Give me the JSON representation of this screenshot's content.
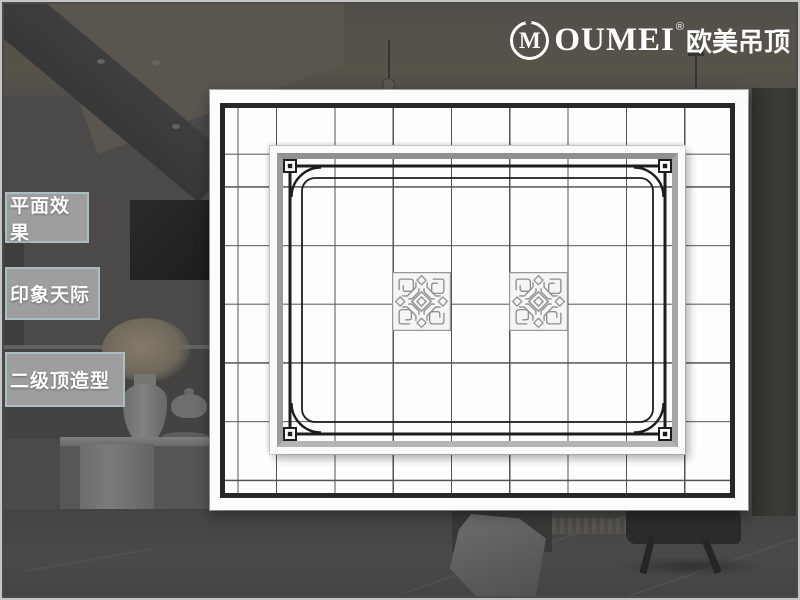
{
  "brand": {
    "symbol": "M",
    "name": "OUMEI",
    "registered_mark": "®",
    "chinese_name": "欧美吊顶"
  },
  "sidebar": {
    "items": [
      {
        "label": "平面效果"
      },
      {
        "label": "印象天际"
      },
      {
        "label": "二级顶造型"
      }
    ]
  },
  "diagram": {
    "kind": "ceiling-plan",
    "description": "Top-down plan of a two-level integrated suspended ceiling: white panel with black perimeter frame, square tile grid, recessed inner panel with white and gray step rings, decorative black line border with corner squares and arcs, and two ornamental pattern tiles",
    "grid": {
      "columns": 9,
      "rows": 7,
      "line_color": "#545454"
    },
    "frame_color": "#282828",
    "panel_background": "#fdfdfd",
    "ornament_tiles": {
      "count": 2,
      "style": "chinese-knot fretwork"
    }
  },
  "background_scene": {
    "description": "dimmed living-room photo: ceiling beam with recessed lights, pendant lamp, wall TV, flower vase, teapot, white TV bench, tiled floor, draped cloth, dark chair, wardrobe"
  },
  "colors": {
    "sidebar_box_bg": "#9e9e9e",
    "sidebar_box_border": "#a9bec2",
    "sidebar_text": "#ffffff",
    "logo_text": "#ffffff",
    "backdrop": "#4b4a48"
  }
}
